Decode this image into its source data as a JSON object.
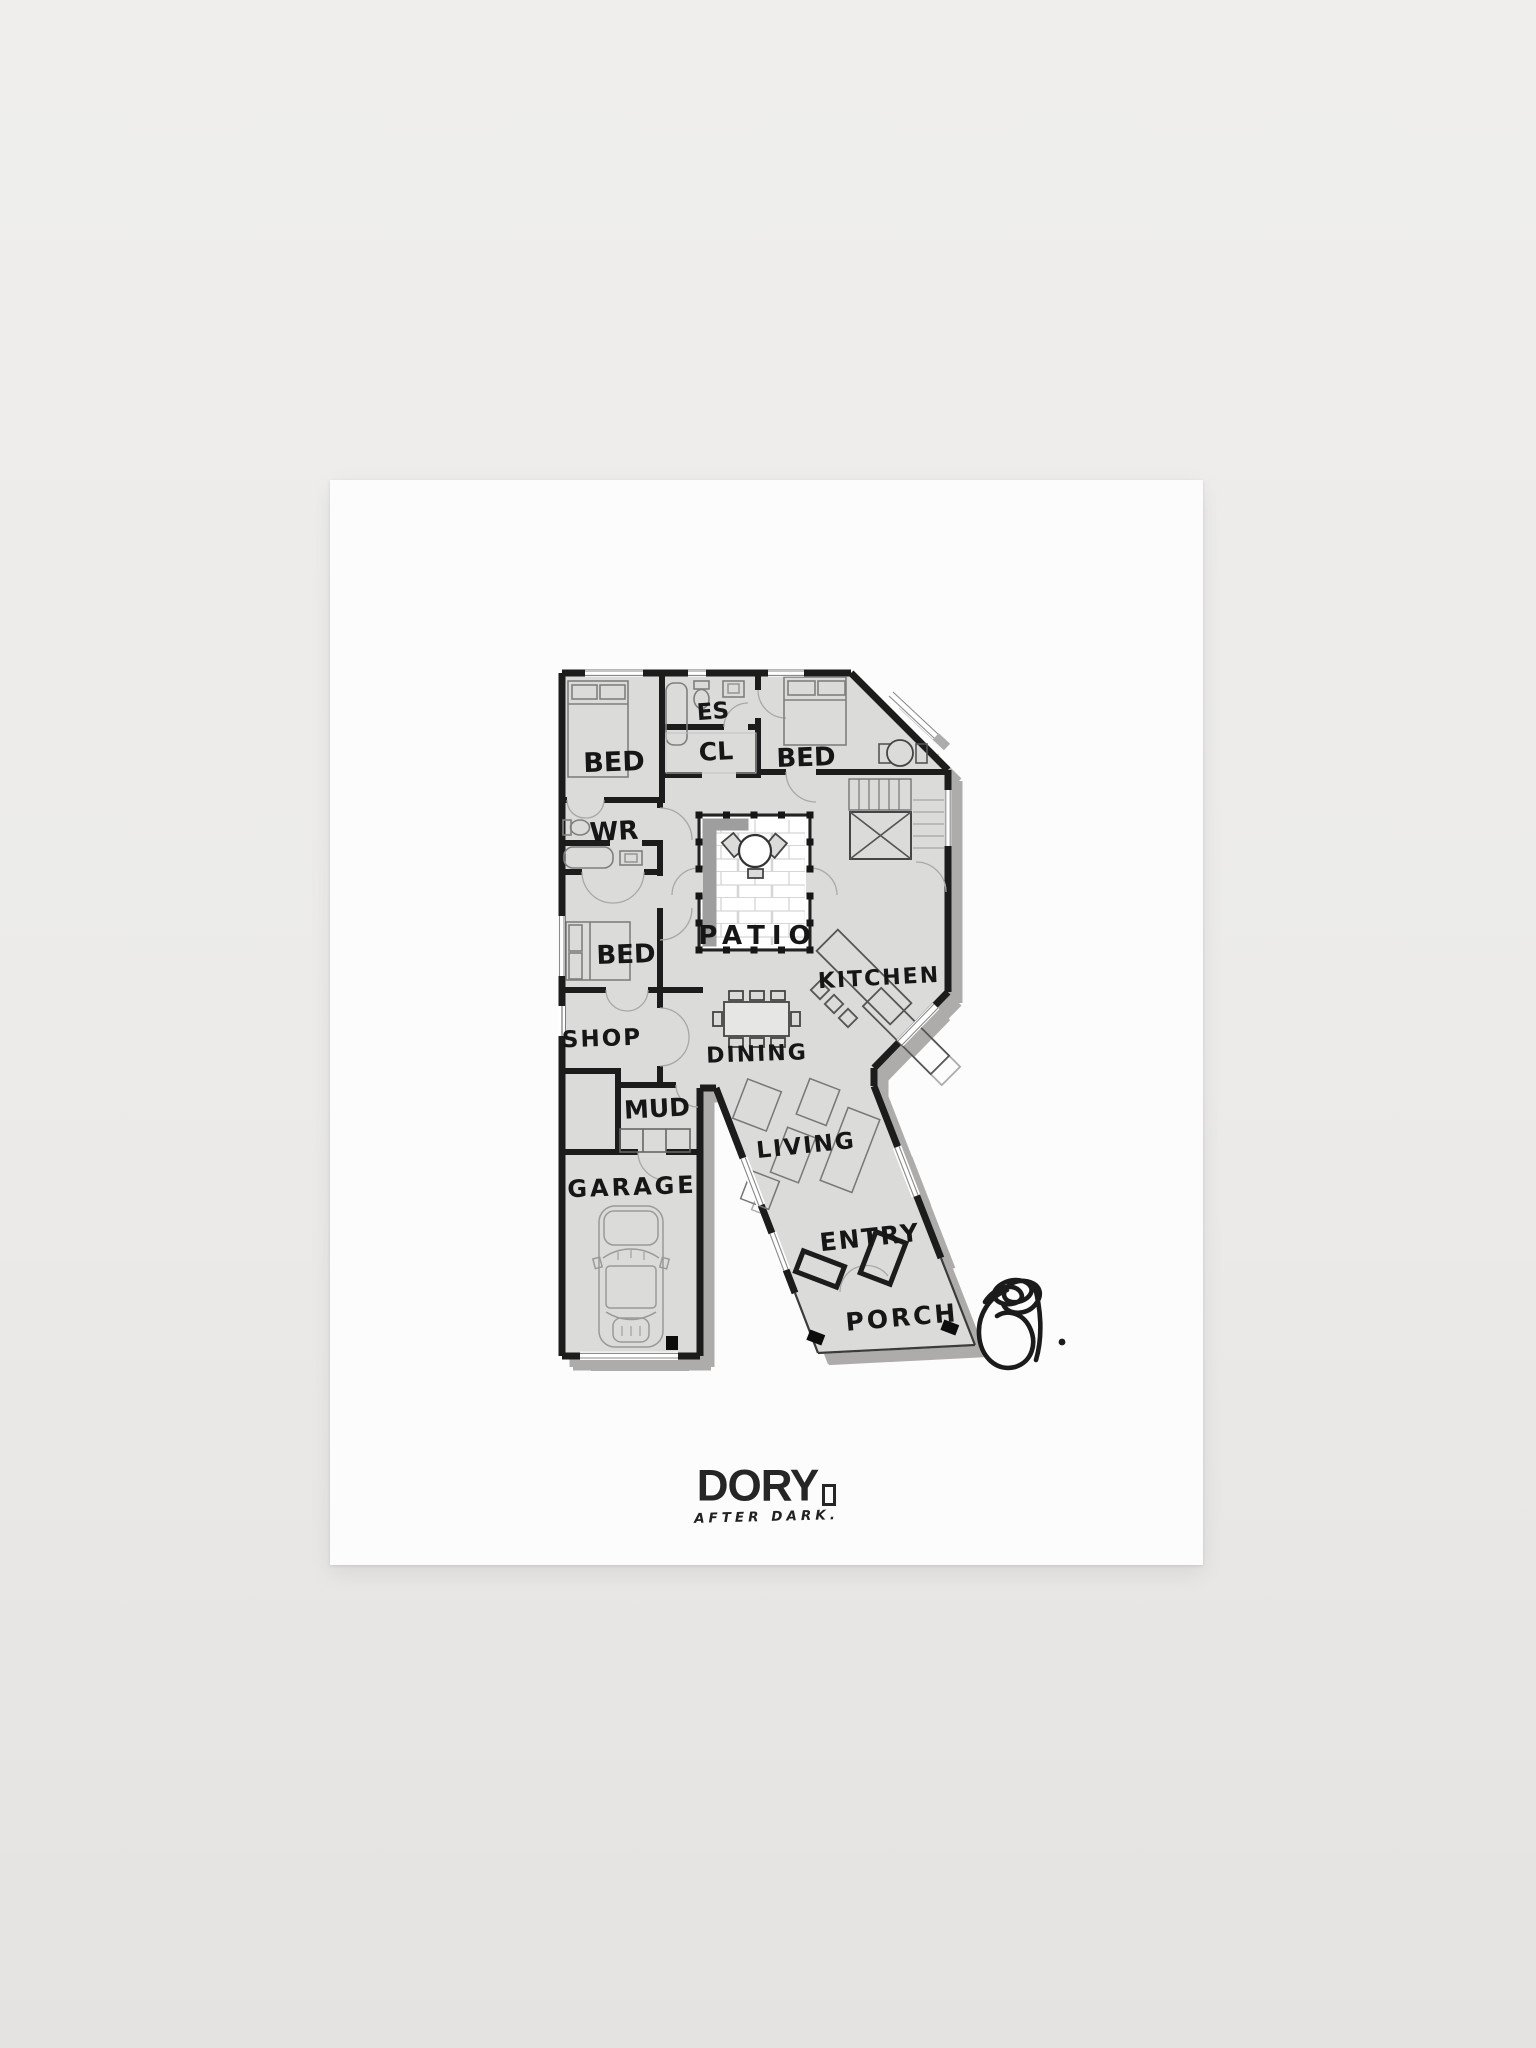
{
  "poster": {
    "plan": {
      "letter": "R",
      "rooms": [
        {
          "id": "bed-1",
          "label": "BED"
        },
        {
          "id": "ensuite",
          "label": "ES"
        },
        {
          "id": "closet",
          "label": "CL"
        },
        {
          "id": "bed-2",
          "label": "BED"
        },
        {
          "id": "washroom",
          "label": "WR"
        },
        {
          "id": "bed-3",
          "label": "BED"
        },
        {
          "id": "patio",
          "label": "PATIO"
        },
        {
          "id": "kitchen",
          "label": "KITCHEN"
        },
        {
          "id": "shop",
          "label": "SHOP"
        },
        {
          "id": "dining",
          "label": "DINING"
        },
        {
          "id": "mud",
          "label": "MUD"
        },
        {
          "id": "living",
          "label": "LIVING"
        },
        {
          "id": "garage",
          "label": "GARAGE"
        },
        {
          "id": "entry",
          "label": "ENTRY"
        },
        {
          "id": "porch",
          "label": "PORCH"
        }
      ],
      "colors": {
        "floor": "#dbdbda",
        "wall": "#1a1a1a",
        "plan_shadow": "#adacab",
        "patio_band": "#9e9e9e",
        "furniture": "#7f7f7f"
      },
      "icons": {
        "car": "car-top-view-icon",
        "signature": "artist-signature"
      }
    },
    "brand": {
      "name": "DORY",
      "tagline": "AFTER DARK.",
      "door_glyph": "door-icon"
    },
    "colors": {
      "paper": "#fcfcfc",
      "background": "#eceae8"
    }
  }
}
